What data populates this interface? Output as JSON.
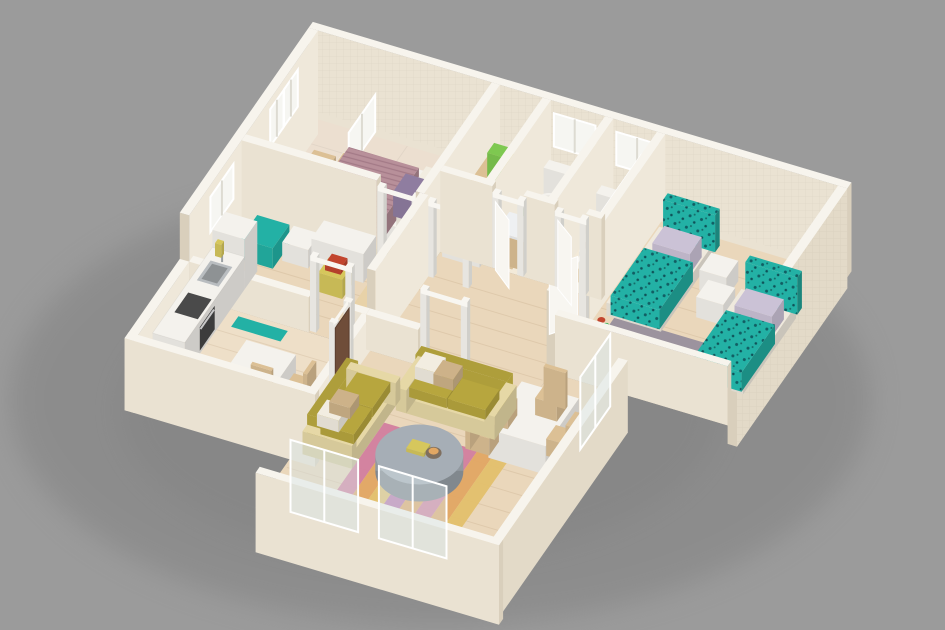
{
  "meta": {
    "content_type": "3d-floor-plan-render",
    "view": "isometric cutaway dollhouse view of an apartment",
    "visible_text": "none"
  },
  "palette": {
    "background": "#9b9b9b",
    "shadow": "#7f7f7f",
    "wallTop": "#f7f4ed",
    "wallFace": "#eae2d2",
    "wallSide": "#d9cfbc",
    "wallExt": "#e3dac8",
    "wallInner": "#efe8da",
    "floorWood": "#ead7bb",
    "floorWoodLight": "#eedfc8",
    "floorTile": "#ecdfd0",
    "floorGreen": "#9aa37f",
    "slatDark": "#d9c099",
    "slatLight": "#f3ead9",
    "white": "#f4f2ed",
    "frameWhite": "#f8f6f1",
    "wood": "#dcc095",
    "woodPale": "#e8d2a8",
    "teal": "#23b1a5",
    "tealDeep": "#12716d",
    "lavender": "#cbc2d6",
    "mauve": "#b8909a",
    "olive": "#b7a63e",
    "sofaFrame": "#e6d8a6",
    "pillowWhite": "#f2ede1",
    "pillowTan": "#cdb289",
    "rugGreen": "#98a284",
    "rugGray": "#9c939e",
    "rugPink": "#d27e9e",
    "rugOrange": "#e2a763",
    "rugYellow": "#e3c06b",
    "rugPurple": "#b976ae",
    "tableGray": "#a6aeb6",
    "steel": "#b9bdc0",
    "appliance": "#3c3c3c",
    "doorBrown": "#6f4d39",
    "glass": "rgba(215,228,230,0.45)",
    "accentYellow": "#d6c75c",
    "accentRed": "#c2452e",
    "plantGreen": "#6fae5a"
  },
  "scene": {
    "rooms": [
      {
        "name": "master-bedroom",
        "furniture": [
          "wood-platform-double-bed",
          "mauve-bedspread",
          "white-pillows",
          "purple-pillow",
          "wood-dresser",
          "wood-bench",
          "green-rug",
          "double-window"
        ]
      },
      {
        "name": "dressing-area",
        "furniture": [
          "wood-cabinet",
          "white-cabinet",
          "green-carpet"
        ]
      },
      {
        "name": "bathroom-1",
        "furniture": [
          "toilet",
          "wood-vanity",
          "plant",
          "slatted-floor",
          "window"
        ]
      },
      {
        "name": "bathroom-2",
        "furniture": [
          "toilet",
          "glass-shower-screen",
          "slatted-floor",
          "window"
        ]
      },
      {
        "name": "kids-bedroom",
        "furniture": [
          "teal-single-bed-1",
          "teal-single-bed-2",
          "white-cube-nightstand-1",
          "white-cube-nightstand-2",
          "gray-rug",
          "floor-toy"
        ]
      },
      {
        "name": "study",
        "furniture": [
          "white-desk",
          "yellow-desk-chair",
          "red-cushion",
          "teal-lounge-chair",
          "white-side-cube",
          "wood-floor-runner",
          "window"
        ]
      },
      {
        "name": "kitchen",
        "furniture": [
          "white-counter",
          "steel-sink",
          "black-oven",
          "cooktop",
          "tall-cabinet",
          "bottle",
          "teal-mat",
          "breakfast-table",
          "wood-chairs"
        ]
      },
      {
        "name": "hallway",
        "furniture": [
          "white-door-frames",
          "white-door-panels"
        ]
      },
      {
        "name": "living-room",
        "furniture": [
          "olive-sofa-main",
          "olive-loveseat",
          "round-gray-coffee-table",
          "striped-rug",
          "white-dining-table",
          "four-wood-chairs",
          "brown-entrance-door",
          "window-frames"
        ]
      }
    ]
  }
}
